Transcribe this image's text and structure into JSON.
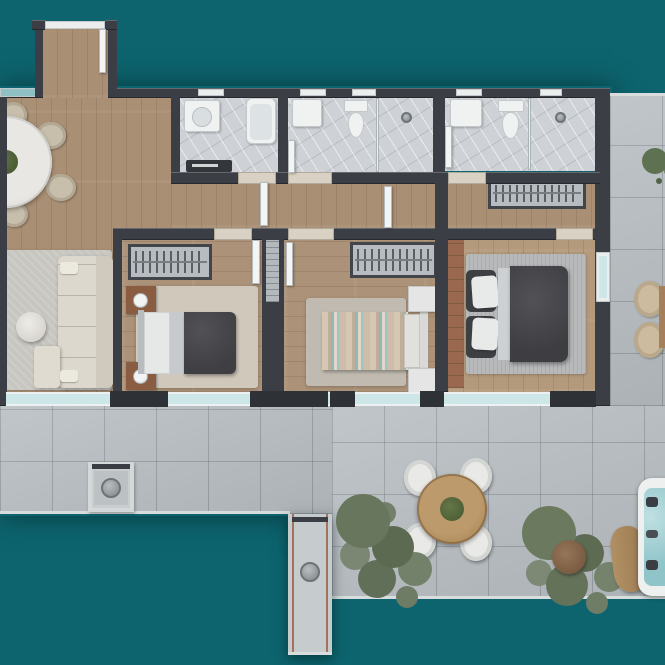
{
  "scene": {
    "type": "apartment-floor-plan-3d-render",
    "view": "top-down",
    "visible_text": "none",
    "background_color": "#0d646e",
    "counts": {
      "bedrooms": 3,
      "bathrooms": 3,
      "terrace_levels": 2
    }
  },
  "palette": {
    "background_teal": "#0d646e",
    "walls": "#3b3e45",
    "wood_floor": "#a98f74",
    "master_wood_floor": "#b49a7c",
    "bathroom_marble": "#ced2d6",
    "terrace_tile": "#b9bfc3",
    "window_glass": "#cde7e9",
    "sofa_cream": "#dcd8cd",
    "dark_duvet": "#46464b",
    "striped_linen_teal": "#8fb8b6",
    "nightstand_wood": "#8a5c41",
    "headboard_panel_wood": "#99684f",
    "outdoor_table_wood": "#b18e61",
    "tree_foliage": "#6d7c64",
    "hot_tub_water": "#a8d2d6"
  },
  "rooms": [
    {
      "name": "entry-hall",
      "floor": "wood",
      "items": [
        "entry-door",
        "open-door-leaf"
      ]
    },
    {
      "name": "dining-area",
      "floor": "wood",
      "items": [
        "round-dining-table",
        "centerpiece-plant",
        "dining-chair (4 visible, set cropped by image edge)"
      ]
    },
    {
      "name": "living-area",
      "floor": "wood",
      "items": [
        "area-rug",
        "l-shaped-sofa",
        "chaise-cushion",
        "round-side-table",
        "throw-pillows"
      ]
    },
    {
      "name": "hallway",
      "floor": "wood",
      "items": [
        "built-in-wardrobe-niche",
        "open-door-leaf"
      ]
    },
    {
      "name": "bathroom-1",
      "floor": "marble",
      "items": [
        "vanity-sink",
        "bathtub",
        "dark-shower-tray",
        "door-leaf",
        "north-window"
      ]
    },
    {
      "name": "bathroom-2",
      "floor": "marble",
      "items": [
        "vanity-sink",
        "toilet",
        "glass-partition",
        "walk-in-shower",
        "door-leaf",
        "north-window"
      ]
    },
    {
      "name": "bathroom-3",
      "floor": "marble",
      "items": [
        "vanity-sink",
        "toilet",
        "glass-partition",
        "walk-in-shower",
        "door-leaf",
        "north-window"
      ]
    },
    {
      "name": "bedroom-1",
      "floor": "wood",
      "items": [
        "wardrobe-with-hangers",
        "double-bed-dark-duvet",
        "wood-nightstand-with-lamp (x2)",
        "area-rug"
      ]
    },
    {
      "name": "bedroom-2",
      "floor": "wood",
      "items": [
        "wardrobe-with-hangers",
        "double-bed-striped-teal-linen",
        "white-nightstand (x2)",
        "area-rug",
        "service-shaft"
      ]
    },
    {
      "name": "master-bedroom",
      "floor": "wood",
      "items": [
        "wood-headboard-panel",
        "double-bed-dark-duvet",
        "striped-area-rug",
        "terrace-door"
      ]
    },
    {
      "name": "terrace",
      "floor": "stone-tile",
      "items": [
        "outdoor-round-dining-table",
        "outdoor-chair (x4)",
        "potted-tree (x2)",
        "round-brown-planter",
        "square-planter-box",
        "long-planter-walkway",
        "hot-tub",
        "wood-slab-bench",
        "edge-lounge-chairs (x2, cropped)",
        "small-corner-plant"
      ]
    }
  ],
  "facade": {
    "south": "continuous floor-to-ceiling glazing band with dark mullion blocks",
    "north": "small clerestory bathroom windows and glazed dining window"
  }
}
